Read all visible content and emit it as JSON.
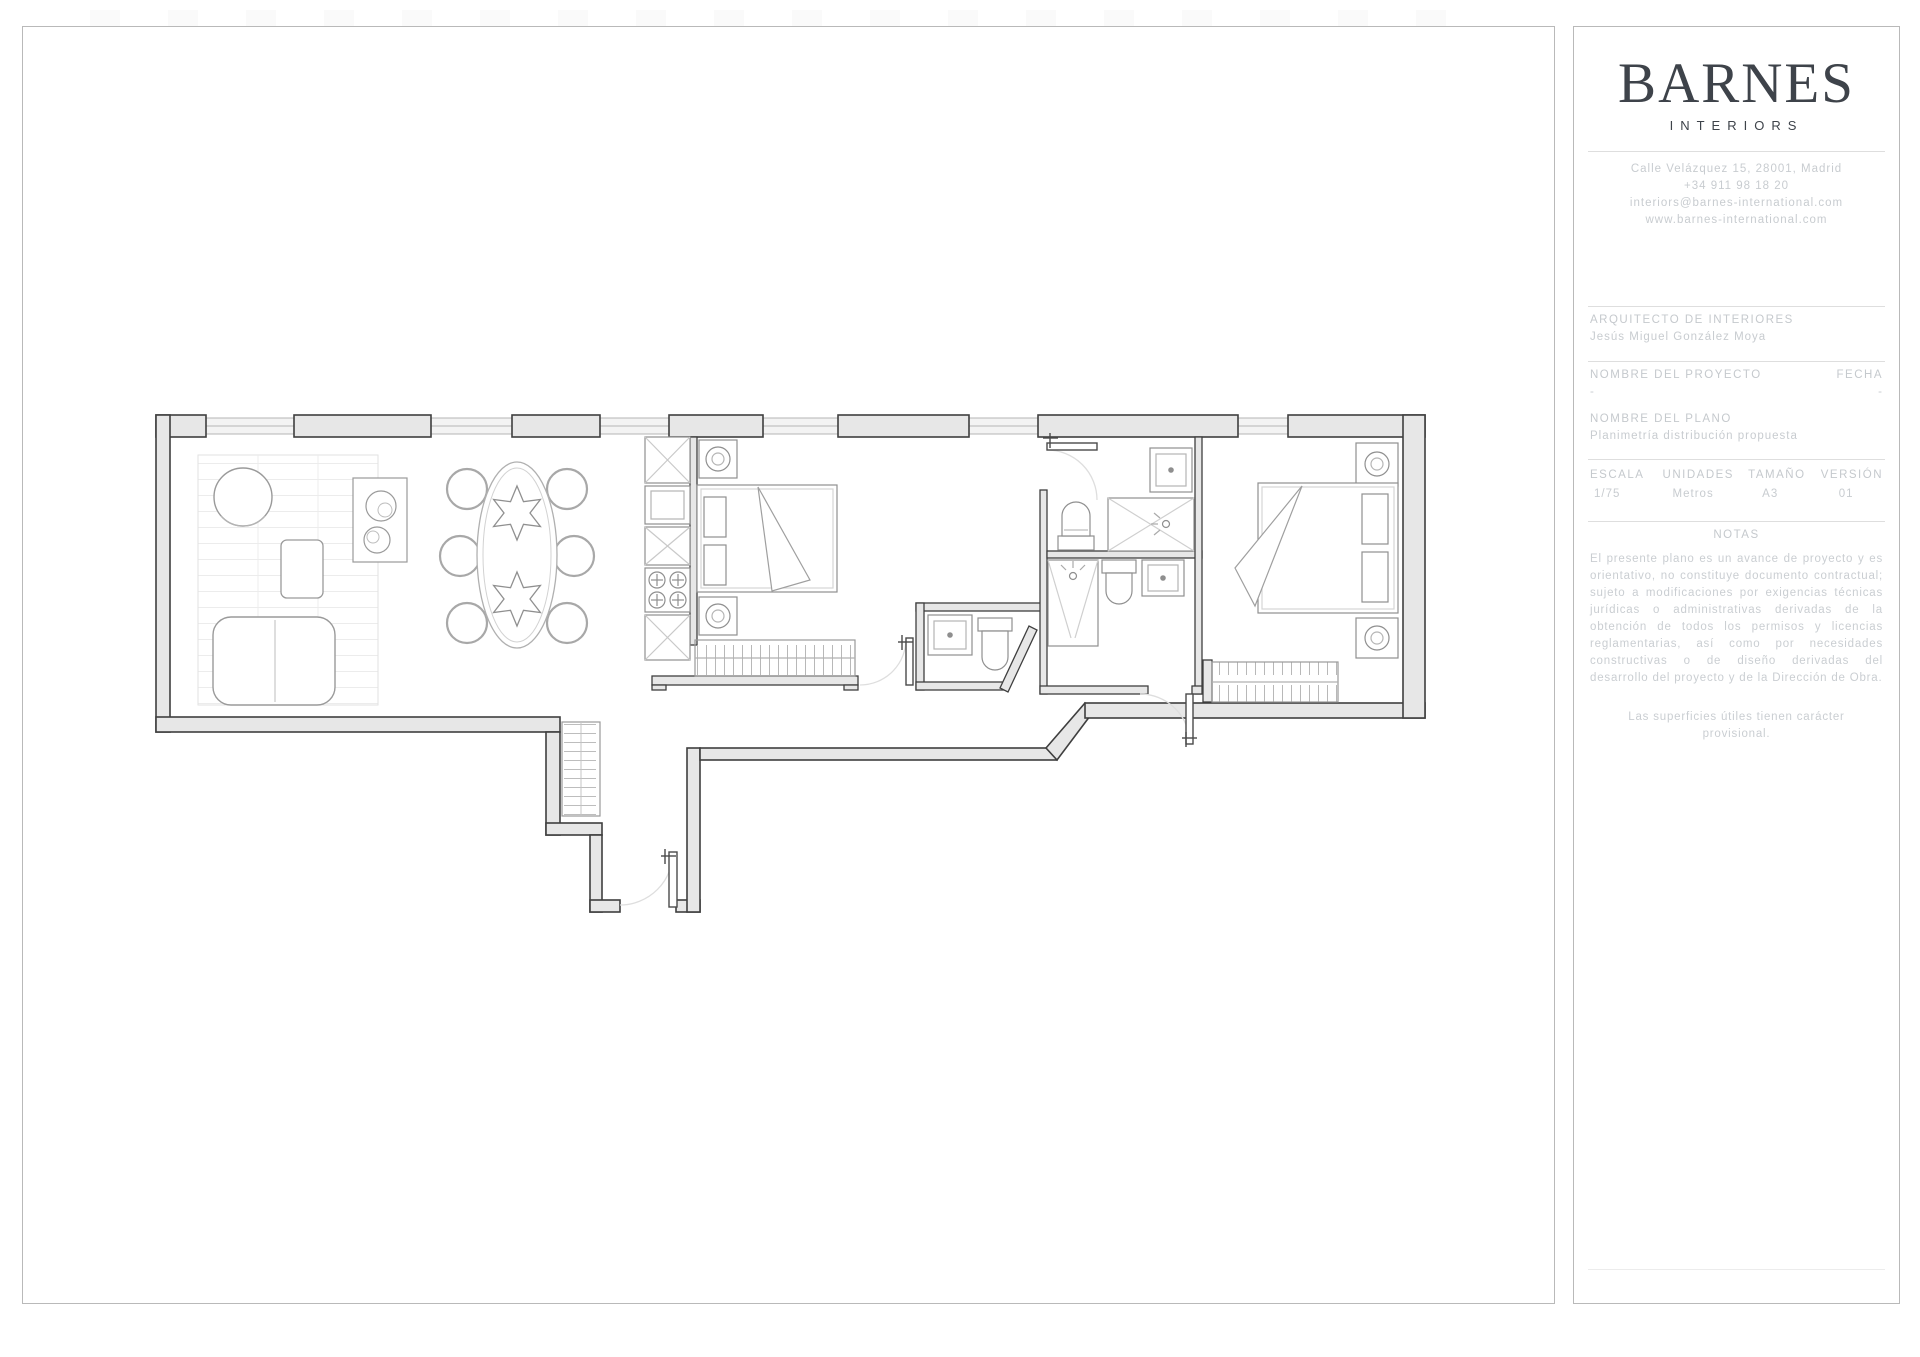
{
  "colors": {
    "wall_fill": "#e7e7e7",
    "wall_stroke": "#3f3f3f",
    "furniture_stroke": "#909090",
    "window_fill": "#f3f3f3",
    "door_arc": "#dedede",
    "logo_text": "#3e434a",
    "title_text": "#c8ccd0"
  },
  "title_block": {
    "logo": {
      "name": "BARNES",
      "subtitle": "INTERIORS"
    },
    "contact": {
      "address": "Calle Velázquez 15, 28001, Madrid",
      "phone": "+34 911 98 18 20",
      "email": "interiors@barnes-international.com",
      "website": "www.barnes-international.com"
    },
    "architect": {
      "label": "ARQUITECTO DE INTERIORES",
      "name": "Jesús Miguel González Moya"
    },
    "project": {
      "label": "NOMBRE DEL PROYECTO",
      "value": "-",
      "date_label": "FECHA",
      "date_value": "-"
    },
    "plan": {
      "label": "NOMBRE DEL PLANO",
      "value": "Planimetría distribución propuesta"
    },
    "specs": {
      "headers": [
        "ESCALA",
        "UNIDADES",
        "TAMAÑO",
        "VERSIÓN"
      ],
      "values": [
        "1/75",
        "Metros",
        "A3",
        "01"
      ]
    },
    "notes": {
      "label": "NOTAS",
      "body": "El presente plano es un avance de proyecto y es orientativo, no constituye documento contractual; sujeto a modificaciones por exigencias técnicas jurídicas o administrativas derivadas de la obtención de todos los permisos y licencias reglamentarias, así como por necesidades constructivas o de diseño derivadas del desarrollo del proyecto y de la Dirección de Obra.",
      "footnote": "Las superficies útiles tienen carácter provisional."
    }
  },
  "floor_plan": {
    "description": "Planta de vivienda: salón-comedor, cocina, dormitorio 1, dos baños, vestíbulo de entrada y dormitorio 2",
    "rooms": [
      "salon-comedor",
      "cocina",
      "dormitorio-1",
      "bano-1",
      "bano-2",
      "aseo",
      "vestibulo",
      "dormitorio-2"
    ]
  }
}
